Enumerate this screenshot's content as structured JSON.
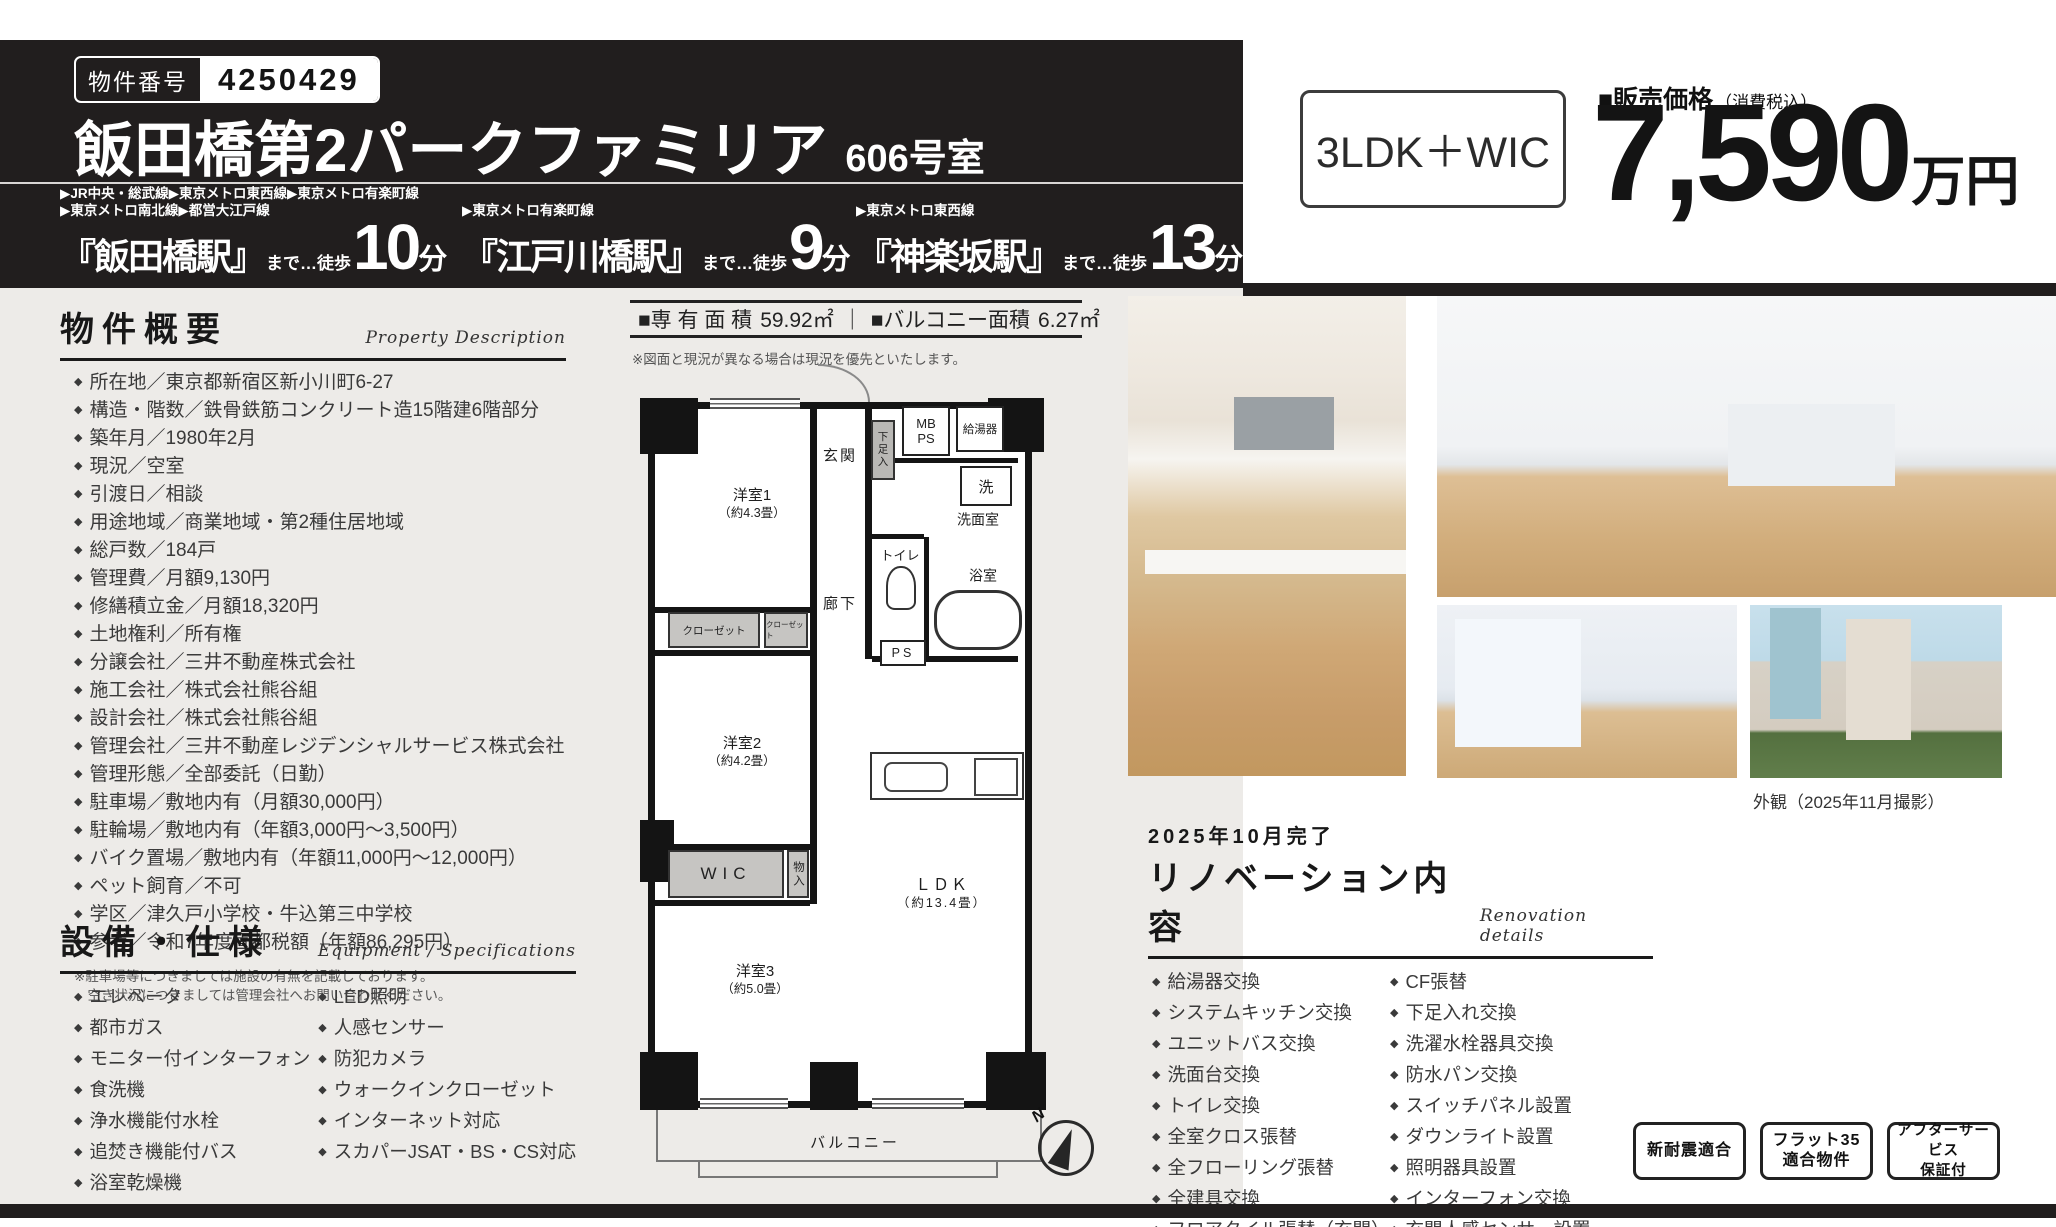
{
  "colors": {
    "header_bg": "#211e1e",
    "panel_bg": "#edebe8",
    "closet_gray": "#c6c5c2",
    "text_dark": "#3a3a3a"
  },
  "header": {
    "badge_label": "物件番号",
    "badge_number": "4250429",
    "title": "飯田橋第2パークファミリア",
    "unit_no": "606号室",
    "stations": [
      {
        "lines1": "▶JR中央・総武線▶東京メトロ東西線▶東京メトロ有楽町線",
        "lines2": "▶東京メトロ南北線▶都営大江戸線",
        "name": "『飯田橋駅』",
        "to": "まで…徒歩",
        "min": "10",
        "unit": "分"
      },
      {
        "lines1": "▶東京メトロ有楽町線",
        "name": "『江戸川橋駅』",
        "to": "まで…徒歩",
        "min": "9",
        "unit": "分"
      },
      {
        "lines1": "▶東京メトロ東西線",
        "name": "『神楽坂駅』",
        "to": "まで…徒歩",
        "min": "13",
        "unit": "分"
      }
    ]
  },
  "price": {
    "plan": "3LDK＋WIC",
    "label": "■販売価格",
    "tax_note": "（消費税込）",
    "amount": "7,590",
    "unit": "万円"
  },
  "area_bar": {
    "label1": "■専 有 面 積",
    "value1": "59.92㎡",
    "divider": "｜",
    "label2": "■バルコニー面積",
    "value2": "6.27㎡",
    "note": "※図面と現況が異なる場合は現況を優先といたします。"
  },
  "overview": {
    "title": "物件概要",
    "subtitle_en": "Property Description",
    "items": [
      "所在地／東京都新宿区新小川町6-27",
      "構造・階数／鉄骨鉄筋コンクリート造15階建6階部分",
      "築年月／1980年2月",
      "現況／空室",
      "引渡日／相談",
      "用途地域／商業地域・第2種住居地域",
      "総戸数／184戸",
      "管理費／月額9,130円",
      "修繕積立金／月額18,320円",
      "土地権利／所有権",
      "分譲会社／三井不動産株式会社",
      "施工会社／株式会社熊谷組",
      "設計会社／株式会社熊谷組",
      "管理会社／三井不動産レジデンシャルサービス株式会社",
      "管理形態／全部委託（日勤）",
      "駐車場／敷地内有（月額30,000円）",
      "駐輪場／敷地内有（年額3,000円～3,500円）",
      "バイク置場／敷地内有（年額11,000円～12,000円）",
      "ペット飼育／不可",
      "学区／津久戸小学校・牛込第三中学校",
      "参考／令和7年度固都税額（年額86,295円）"
    ],
    "note1": "※駐車場等につきましては施設の有無を記載しております。",
    "note2": "　空き状況につきましては管理会社へお問い合わせください。"
  },
  "equipment": {
    "title": "設備・仕様",
    "subtitle_en": "Equipment / Specifications",
    "col1": [
      "エレベータ",
      "都市ガス",
      "モニター付インターフォン",
      "食洗機",
      "浄水機能付水栓",
      "追焚き機能付バス",
      "浴室乾燥機"
    ],
    "col2": [
      "LED照明",
      "人感センサー",
      "防犯カメラ",
      "ウォークインクローゼット",
      "インターネット対応",
      "スカパーJSAT・BS・CS対応"
    ]
  },
  "floorplan": {
    "room1": "洋室1",
    "room1_size": "（約4.3畳）",
    "room2": "洋室2",
    "room2_size": "（約4.2畳）",
    "room3": "洋室3",
    "room3_size": "（約5.0畳）",
    "ldk": "ＬＤＫ",
    "ldk_size": "（約13.4畳）",
    "genkan": "玄関",
    "rouka": "廊下",
    "senmenshitsu": "洗面室",
    "toilet": "トイレ",
    "bath": "浴室",
    "wash": "洗",
    "wic": "WIC",
    "monoire": "物入",
    "shitasokuire": "下足入",
    "closet1": "クローゼット",
    "closet2": "クローゼット",
    "mb": "MB",
    "mb_ps": "PS",
    "ps": "PS",
    "boiler": "給湯器",
    "balcony": "バルコニー",
    "compass_n": "N"
  },
  "photos": {
    "caption": "外観（2025年11月撮影）"
  },
  "renovation": {
    "completed": "2025年10月完了",
    "title": "リノベーション内容",
    "subtitle_en": "Renovation details",
    "col1": [
      "給湯器交換",
      "システムキッチン交換",
      "ユニットバス交換",
      "洗面台交換",
      "トイレ交換",
      "全室クロス張替",
      "全フローリング張替",
      "全建具交換",
      "フロアタイル張替（玄関）"
    ],
    "col2": [
      "CF張替",
      "下足入れ交換",
      "洗濯水栓器具交換",
      "防水パン交換",
      "スイッチパネル設置",
      "ダウンライト設置",
      "照明器具設置",
      "インターフォン交換",
      "玄関人感センサー設置"
    ]
  },
  "badges": [
    {
      "line1": "新耐震適合"
    },
    {
      "line1": "フラット35",
      "line2": "適合物件"
    },
    {
      "line1": "アフターサービス",
      "line2": "保証付"
    }
  ]
}
